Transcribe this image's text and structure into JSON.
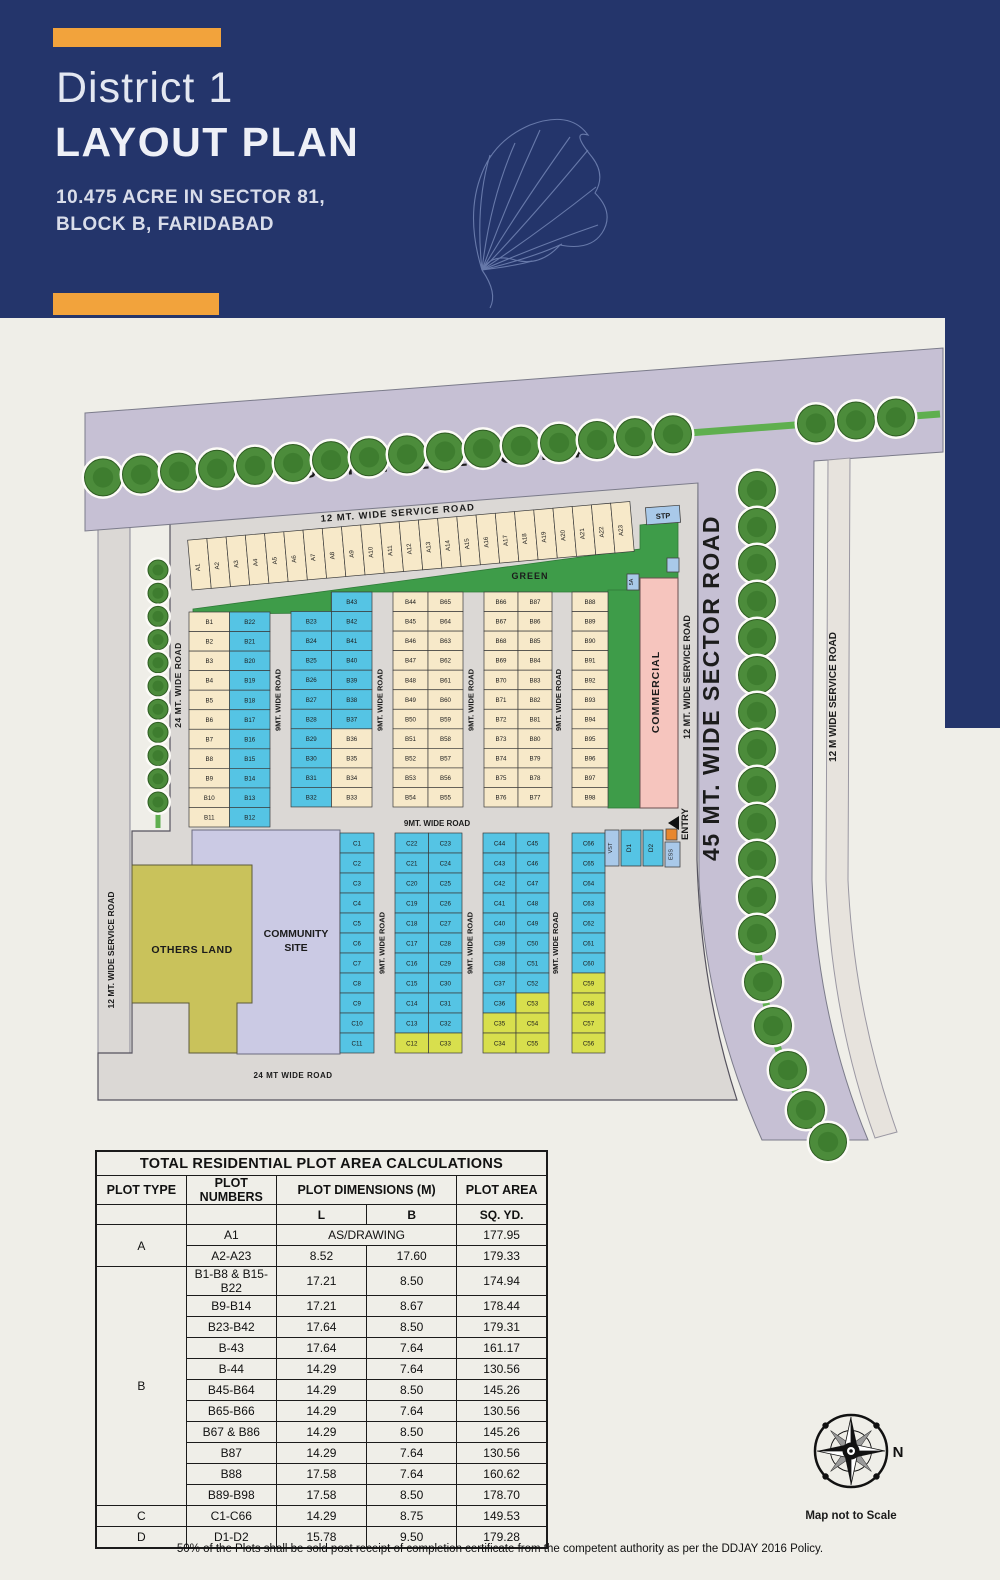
{
  "header": {
    "title_line1": "District 1",
    "title_line2": "LAYOUT PLAN",
    "subtitle_line1": "10.475 ACRE IN SECTOR 81,",
    "subtitle_line2": "BLOCK B, FARIDABAD"
  },
  "map": {
    "labels": {
      "sector_road_top": "45 MT. WIDE SECTOR ROAD",
      "service_road_top": "12 MT. WIDE SERVICE ROAD",
      "road_9_vertical": "9MT. WIDE ROAD",
      "road_9_horizontal": "9MT. WIDE ROAD",
      "road_24_left": "24 MT. WIDE ROAD",
      "road_24_bottom": "24 MT WIDE ROAD",
      "service_road_left": "12 MT. WIDE SERVICE ROAD",
      "service_road_right_inner": "12 MT. WIDE SERVICE ROAD",
      "sector_road_right": "45 MT. WIDE SECTOR ROAD",
      "service_road_right_outer": "12 M WIDE SERVICE ROAD",
      "green": "GREEN",
      "commercial": "COMMERCIAL",
      "others_land": "OTHERS LAND",
      "community_site": "COMMUNITY SITE",
      "entry": "ENTRY",
      "stp": "STP",
      "vst": "VST",
      "ess": "ESS",
      "box_5a": "5A",
      "d1": "D1",
      "d2": "D2"
    },
    "plots": {
      "a_row": "A1-A23",
      "b_block": {
        "col1": {
          "left": "B1-B11",
          "right": "B22-B12"
        },
        "col2": {
          "top_right": "B43",
          "left": "B23-B32",
          "right": "B42-B33"
        },
        "col3": {
          "left": "B44-B54",
          "right": "B65-B55"
        },
        "col4": {
          "left": "B66-B76",
          "right": "B87-B77"
        },
        "col5": {
          "single": "B88-B98"
        }
      },
      "c_block": {
        "col1": {
          "single": "C1-C11"
        },
        "col2": {
          "left": "C22-C12",
          "right": "C23-C33"
        },
        "col3": {
          "left": "C44-C34",
          "right": "C45-C55"
        },
        "col4": {
          "single": "C66-C56"
        }
      },
      "d_plots": "D1-D2"
    },
    "colors": {
      "navy": "#24356B",
      "orange": "#F2A33C",
      "page_bg": "#EFEEE8",
      "estate_grey": "#DBD8D5",
      "road_lavender": "#C6C0D4",
      "service_strip": "#E7E3DD",
      "plot_cream": "#F7E9C9",
      "plot_blue": "#55C4E4",
      "plot_yellow": "#D8DF4D",
      "green_area": "#3E9C49",
      "others_land": "#C9C25B",
      "community": "#CBCAE4",
      "commercial": "#F6C5BE",
      "utility_box": "#A9C9E9",
      "entry_orange": "#E8872E",
      "blue_plots": [
        "B12-B32",
        "B37-B43",
        "C1-C11",
        "C13-C32",
        "C36-C52",
        "C60-C66",
        "D1-D2"
      ],
      "yellow_plots": [
        "C12",
        "C33-C35",
        "C53-C59"
      ]
    }
  },
  "table": {
    "title": "TOTAL RESIDENTIAL PLOT AREA CALCULATIONS",
    "col_headers": [
      "PLOT TYPE",
      "PLOT  NUMBERS",
      "PLOT DIMENSIONS (M)",
      "PLOT AREA"
    ],
    "sub_headers": [
      "L",
      "B",
      "SQ. YD."
    ],
    "rows": [
      {
        "type": "A",
        "type_span": 2,
        "numbers": "A1",
        "dims_merged": "AS/DRAWING",
        "area": "177.95"
      },
      {
        "numbers": "A2-A23",
        "l": "8.52",
        "b": "17.60",
        "area": "179.33"
      },
      {
        "type": "B",
        "type_span": 11,
        "numbers": "B1-B8 & B15-B22",
        "l": "17.21",
        "b": "8.50",
        "area": "174.94"
      },
      {
        "numbers": "B9-B14",
        "l": "17.21",
        "b": "8.67",
        "area": "178.44"
      },
      {
        "numbers": "B23-B42",
        "l": "17.64",
        "b": "8.50",
        "area": "179.31"
      },
      {
        "numbers": "B-43",
        "l": "17.64",
        "b": "7.64",
        "area": "161.17"
      },
      {
        "numbers": "B-44",
        "l": "14.29",
        "b": "7.64",
        "area": "130.56"
      },
      {
        "numbers": "B45-B64",
        "l": "14.29",
        "b": "8.50",
        "area": "145.26"
      },
      {
        "numbers": "B65-B66",
        "l": "14.29",
        "b": "7.64",
        "area": "130.56"
      },
      {
        "numbers": "B67 & B86",
        "l": "14.29",
        "b": "8.50",
        "area": "145.26"
      },
      {
        "numbers": "B87",
        "l": "14.29",
        "b": "7.64",
        "area": "130.56"
      },
      {
        "numbers": "B88",
        "l": "17.58",
        "b": "7.64",
        "area": "160.62"
      },
      {
        "numbers": "B89-B98",
        "l": "17.58",
        "b": "8.50",
        "area": "178.70"
      },
      {
        "type": "C",
        "type_span": 1,
        "numbers": "C1-C66",
        "l": "14.29",
        "b": "8.75",
        "area": "149.53"
      },
      {
        "type": "D",
        "type_span": 1,
        "numbers": "D1-D2",
        "l": "15.78",
        "b": "9.50",
        "area": "179.28"
      }
    ]
  },
  "footnote": {
    "text": "50% of the Plots shall be sold post receipt of completion certificate from the competent authority as per the DDJAY 2016 Policy."
  },
  "compass": {
    "north_label": "N",
    "caption": "Map not to Scale"
  }
}
